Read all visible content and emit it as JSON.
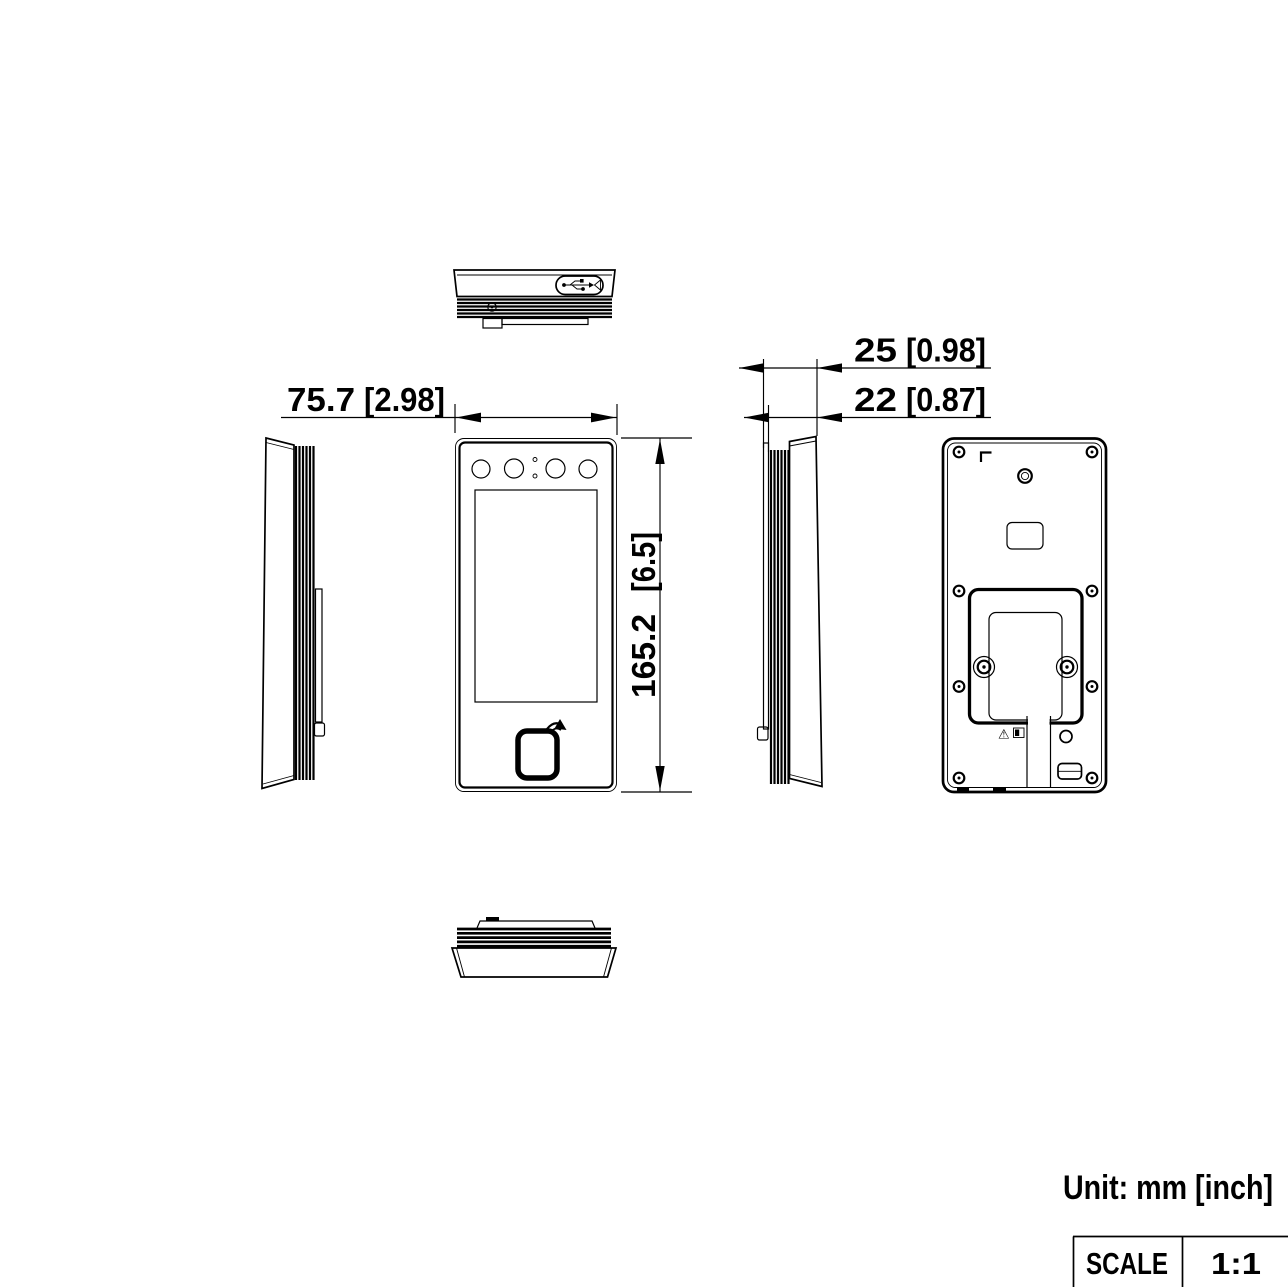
{
  "unit_note": "Unit: mm [inch]",
  "scale_table": {
    "label": "SCALE",
    "value": "1:1"
  },
  "dimensions": {
    "front_width": {
      "mm": "75.7",
      "inch": "[2.98]"
    },
    "front_height": {
      "mm": "165.2",
      "inch": "[6.5]"
    },
    "depth_overall": {
      "mm": "25",
      "inch": "[0.98]"
    },
    "depth_body": {
      "mm": "22",
      "inch": "[0.87]"
    }
  },
  "icons": {
    "warning_glyph": "⚠",
    "usb_icon": "usb-symbol",
    "card_reader_icon": "contactless-card-tap",
    "screw_icon": "screw-hole"
  },
  "colors": {
    "line": "#000000",
    "background": "#ffffff"
  }
}
